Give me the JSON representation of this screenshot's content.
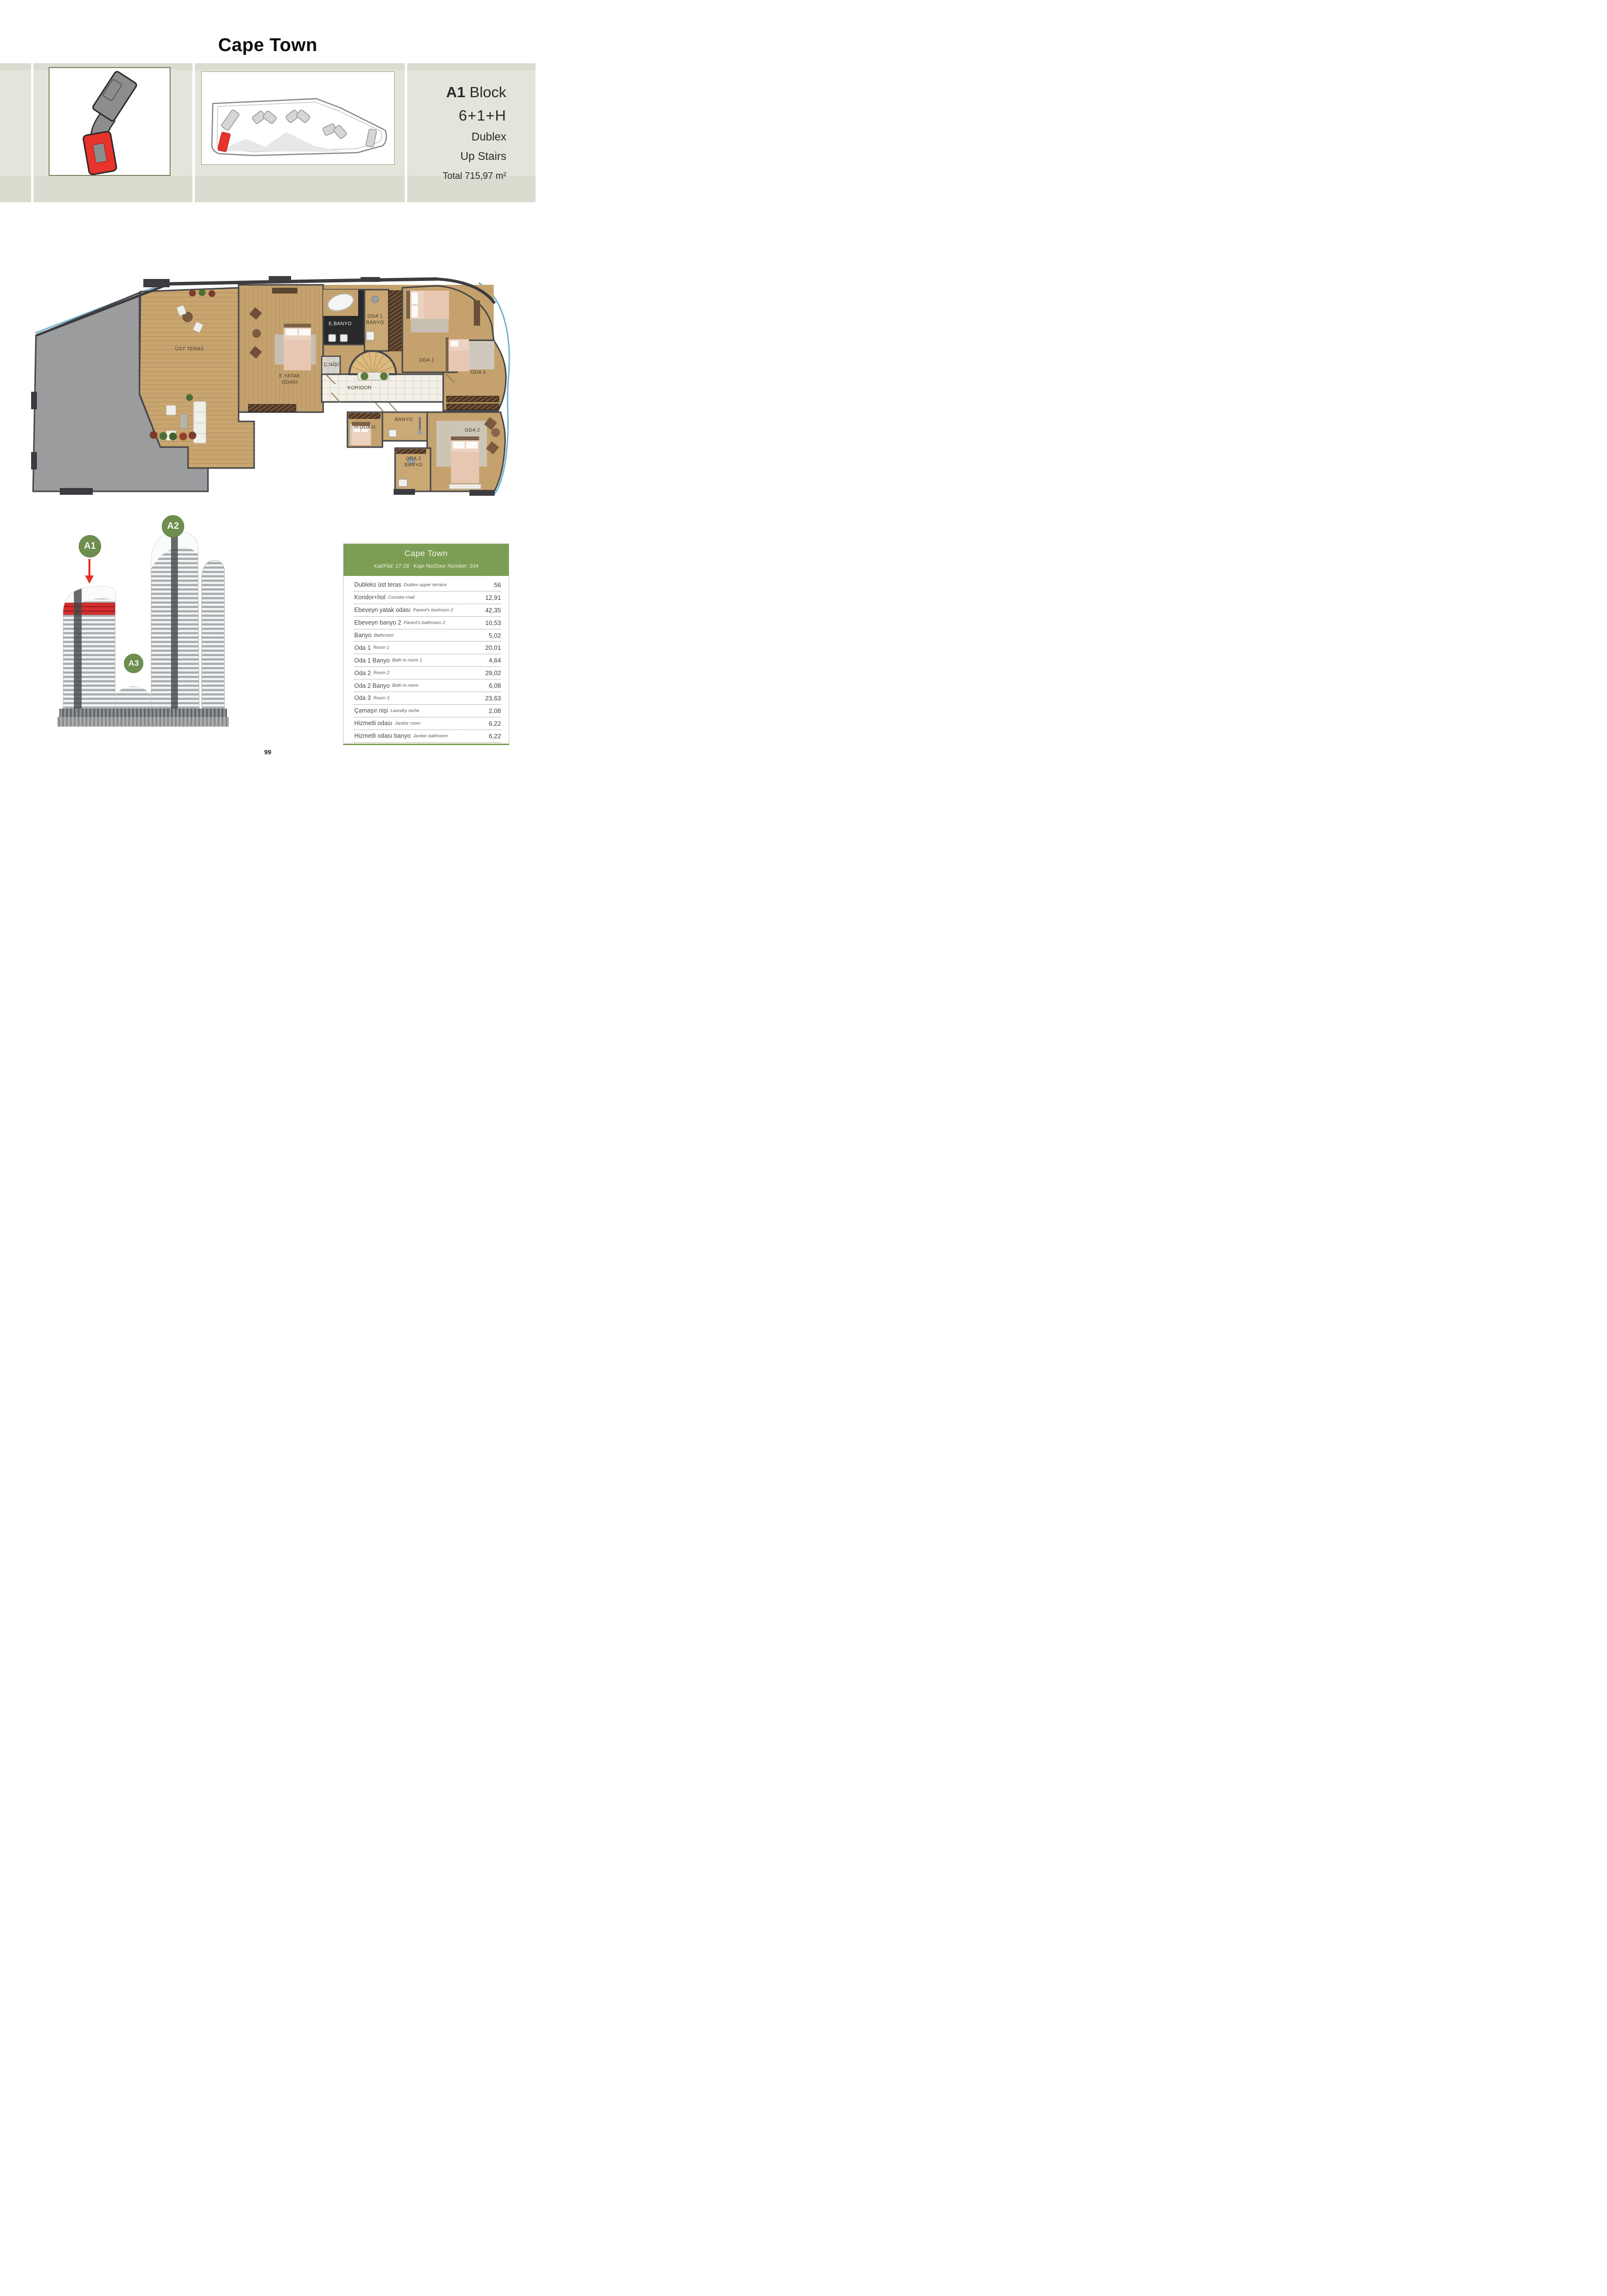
{
  "page": {
    "title": "Cape Town",
    "page_number": "99"
  },
  "header": {
    "block_bold": "A1",
    "block_rest": " Block",
    "layout": "6+1+H",
    "type": "Dublex",
    "stairs": "Up Stairs",
    "total": "Total 715,97 m²"
  },
  "colors": {
    "band": "#e3e5da",
    "accent_green": "#7c9e54",
    "badge_green": "#6e8e4e",
    "highlight_red": "#e8332a",
    "wood": "#c5a26d",
    "slab_gray": "#9b9c9e",
    "wall": "#3e3e42"
  },
  "icons": {
    "thumb1": "block-footprint-keyplan-icon",
    "thumb2": "site-floorplate-keyplan-icon"
  },
  "floor_plan": {
    "labels": {
      "ust_teras": "ÜST TERAS",
      "e_yatak": "E.YATAK\nODASI",
      "e_banyo": "E.BANYO",
      "oda1_banyo": "ODA 1\nBANYO",
      "c_nisi": "Ç.NİŞİ",
      "koridor": "KORİDOR",
      "oda1": "ODA 1",
      "oda3": "ODA 3",
      "h_odasi": "H.ODASI",
      "banyo": "BANYO",
      "oda2": "ODA 2",
      "oda2_banyo": "ODA 2\nBANYO"
    }
  },
  "building": {
    "a1": "A1",
    "a2": "A2",
    "a3": "A3"
  },
  "table": {
    "title": "Cape Town",
    "kat_prefix": "Kat/",
    "kat_italic": "Flat",
    "kat_value": ":  27-28",
    "kapi_prefix": "Kapı No/",
    "kapi_italic": "Door Number",
    "kapi_value": ":  104",
    "rows": [
      {
        "tr": "Dubleks üst teras",
        "en": "Dublex upper terrace",
        "value": "56"
      },
      {
        "tr": "Koridor+hol",
        "en": "Corridor+hall",
        "value": "12,91"
      },
      {
        "tr": "Ebeveyn yatak odası",
        "en": "Parent's bedroom 2",
        "value": "42,35"
      },
      {
        "tr": "Ebeveyn banyo 2",
        "en": "Parent's bathroom 2",
        "value": "10,53"
      },
      {
        "tr": "Banyo",
        "en": "Bathroom",
        "value": "5,02"
      },
      {
        "tr": "Oda 1",
        "en": "Room 1",
        "value": "20,01"
      },
      {
        "tr": "Oda 1 Banyo",
        "en": "Bath in room 1",
        "value": "4,64"
      },
      {
        "tr": "Oda 2",
        "en": "Room 2",
        "value": "29,02"
      },
      {
        "tr": "Oda 2 Banyo",
        "en": "Bath in room",
        "value": "6,08"
      },
      {
        "tr": "Oda 3",
        "en": "Room 3",
        "value": "23,63"
      },
      {
        "tr": "Çamaşır nişi",
        "en": "Laundry niche",
        "value": "2,08"
      },
      {
        "tr": "Hizmetli odası",
        "en": "Janitor room",
        "value": "6,22"
      },
      {
        "tr": "Hizmetli odası banyo",
        "en": "Janitor bathroom",
        "value": "6,22"
      }
    ]
  }
}
